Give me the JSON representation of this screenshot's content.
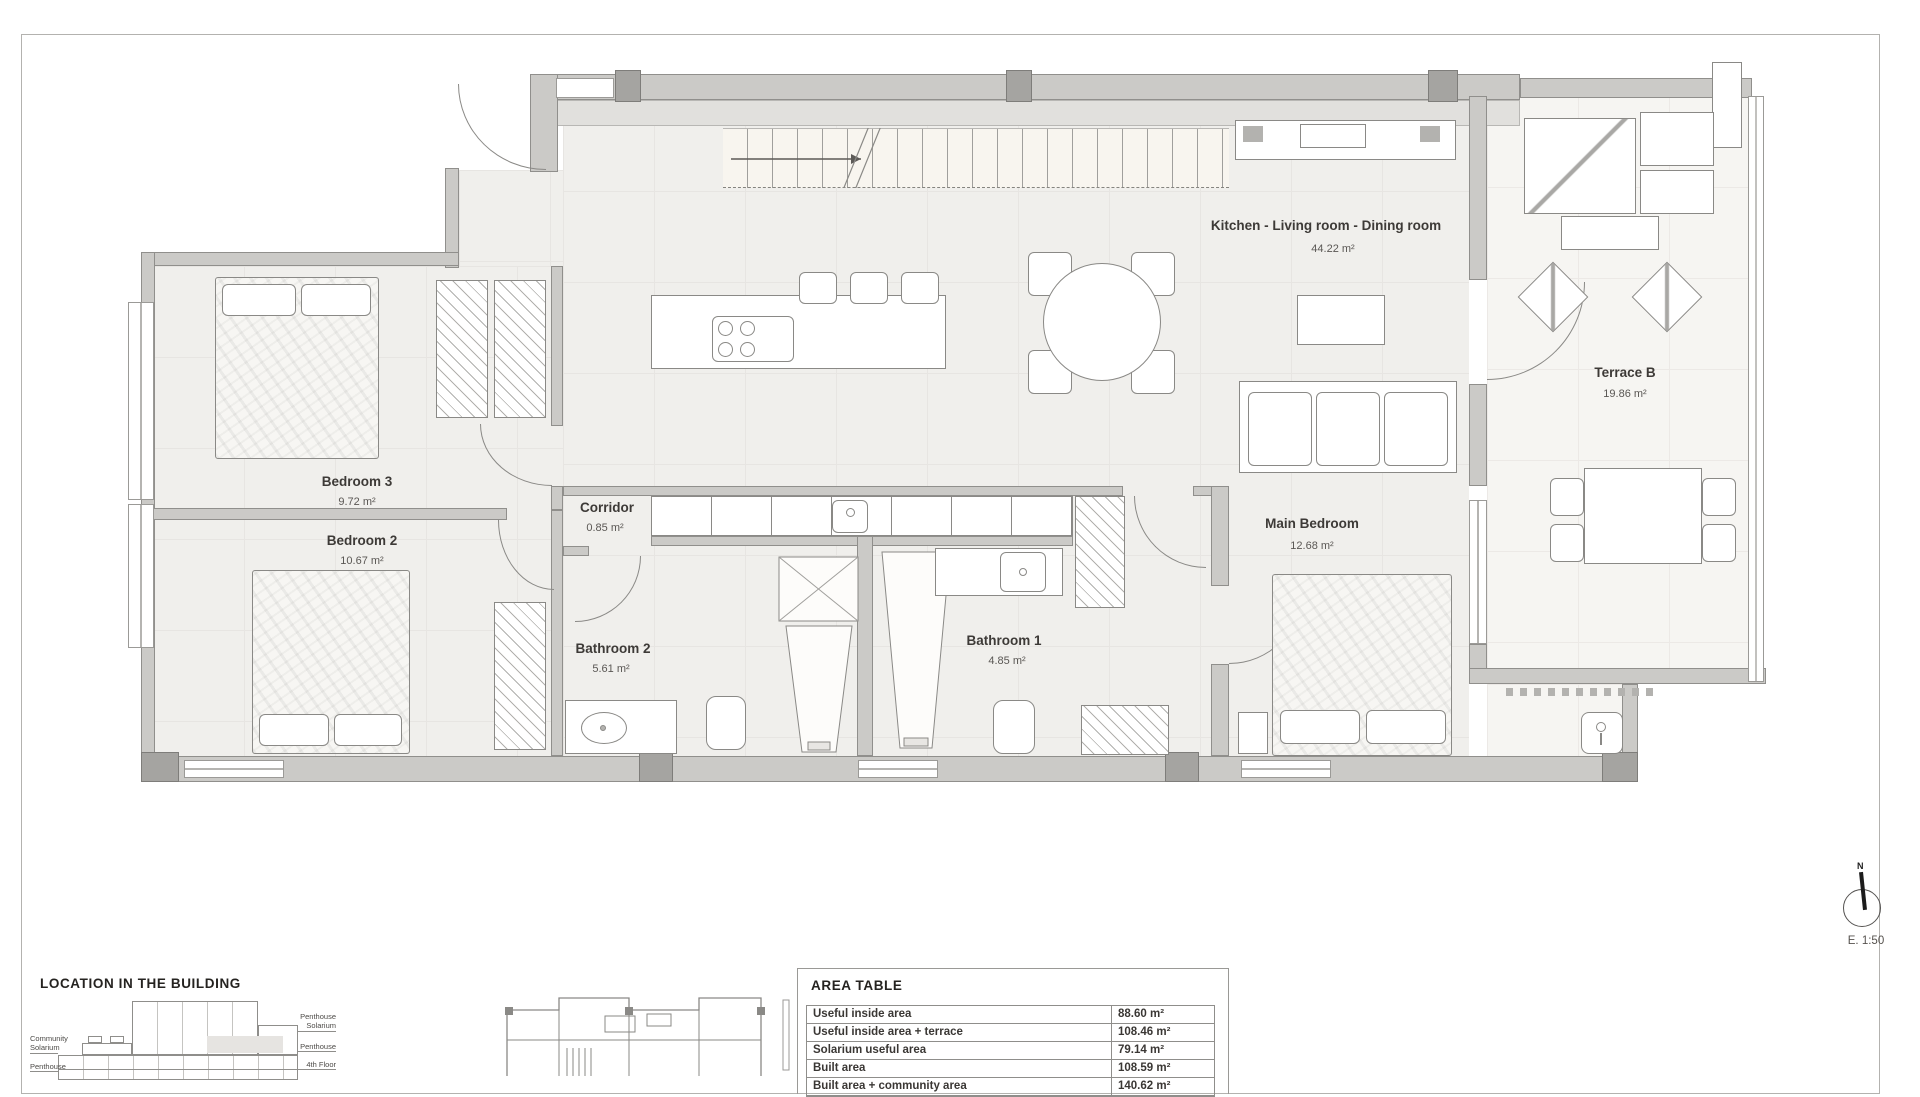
{
  "plan": {
    "rooms": [
      {
        "name": "Bedroom 3",
        "area": "9.72 m²"
      },
      {
        "name": "Bedroom 2",
        "area": "10.67 m²"
      },
      {
        "name": "Corridor",
        "area": "0.85 m²"
      },
      {
        "name": "Bathroom 2",
        "area": "5.61 m²"
      },
      {
        "name": "Bathroom 1",
        "area": "4.85 m²"
      },
      {
        "name": "Main Bedroom",
        "area": "12.68 m²"
      },
      {
        "name": "Kitchen - Living room - Dining room",
        "area": "44.22 m²"
      },
      {
        "name": "Terrace B",
        "area": "19.86 m²"
      }
    ]
  },
  "location_section": {
    "title": "LOCATION IN THE BUILDING",
    "left_labels": [
      "Community\nSolarium",
      "Penthouse"
    ],
    "right_labels": [
      "Penthouse\nSolarium",
      "Penthouse",
      "4th Floor"
    ]
  },
  "area_table": {
    "title": "AREA TABLE",
    "rows": [
      {
        "label": "Useful inside area",
        "value": "88.60 m²"
      },
      {
        "label": "Useful inside area + terrace",
        "value": "108.46 m²"
      },
      {
        "label": "Solarium useful area",
        "value": "79.14 m²"
      },
      {
        "label": "Built area",
        "value": "108.59 m²"
      },
      {
        "label": "Built area + community area",
        "value": "140.62 m²"
      }
    ]
  },
  "compass": {
    "north_label": "N",
    "scale": "E. 1:50"
  }
}
